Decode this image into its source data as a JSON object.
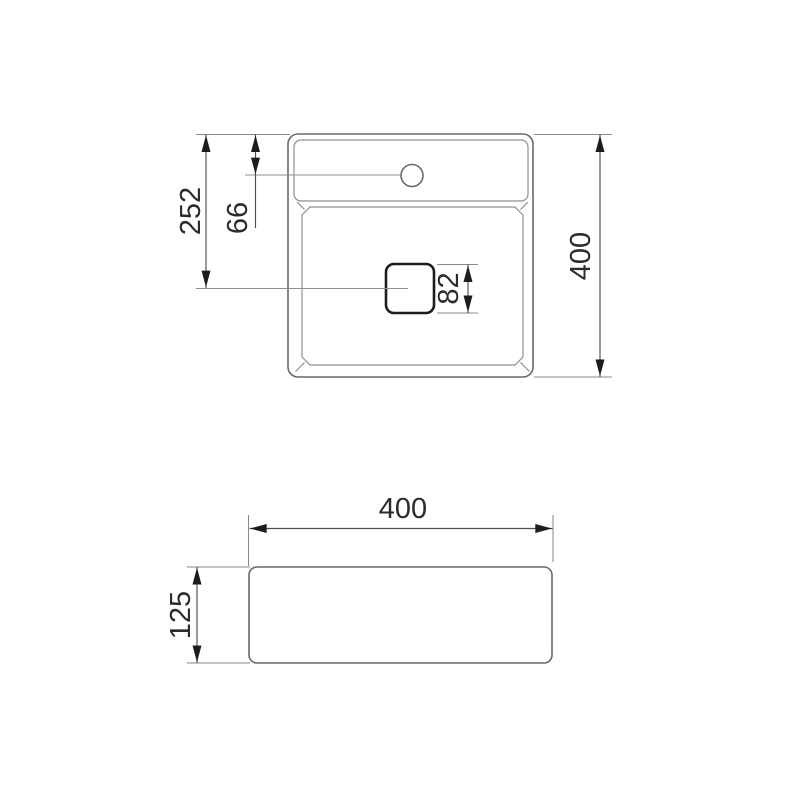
{
  "drawing": {
    "kind": "technical-dimension-drawing",
    "subject": "square washbasin with faucet hole and square drain",
    "units_shown": "mm",
    "colors": {
      "background": "#ffffff",
      "outline_color": "#696969",
      "detail_color": "#8f8f8f",
      "extension_color": "#8a8a8a",
      "dimension_color": "#4f4f4f",
      "accent_color": "#1d1d1d",
      "text_color": "#2b2b2b"
    },
    "top_view": {
      "dims": {
        "drain_center_from_top": "252",
        "faucet_center_from_top": "66",
        "drain_size": "82",
        "overall_depth": "400"
      }
    },
    "front_view": {
      "dims": {
        "overall_width": "400",
        "body_height": "125"
      }
    }
  }
}
